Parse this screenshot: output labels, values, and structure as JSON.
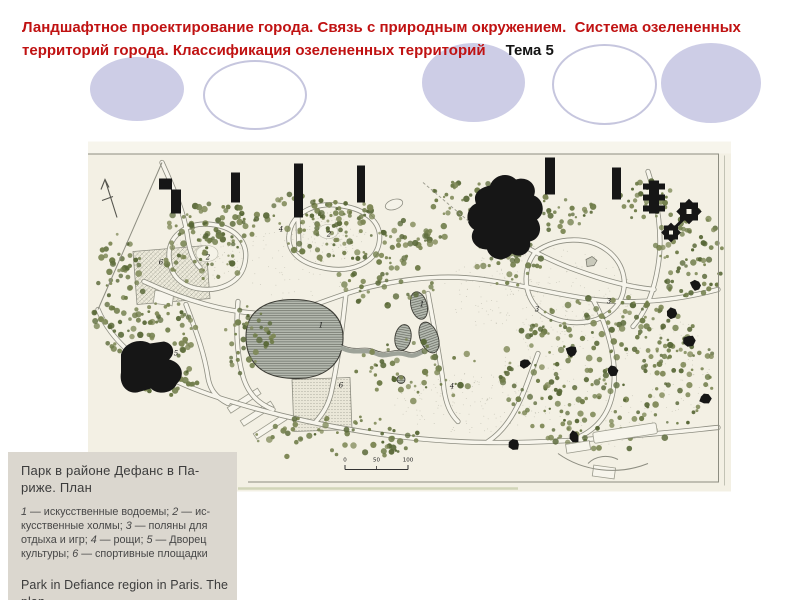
{
  "header": {
    "title": "Ландшафтное проектирование города. Связь с природным окружением.  Система озелененных территорий города. Классификация озелененных территорий",
    "topic": "Тема 5"
  },
  "colors": {
    "title_red": "#c01212",
    "topic_black": "#141414",
    "ellipse_fill": "#cdcde6",
    "ellipse_stroke": "#c6c6de",
    "plan_paper": "#f3f0e4",
    "plan_line": "#8d8d81",
    "tree_green": "#6f7c49",
    "building_black": "#161616",
    "pond_fill": "#b7bcb2",
    "caption_bg": "#dbd7cf",
    "caption_text": "#3c3c3c"
  },
  "plan": {
    "labels": [
      {
        "n": "6",
        "x": 73,
        "y": 123
      },
      {
        "n": "2",
        "x": 120,
        "y": 118
      },
      {
        "n": "4",
        "x": 193,
        "y": 90
      },
      {
        "n": "2",
        "x": 241,
        "y": 95
      },
      {
        "n": "1",
        "x": 233,
        "y": 186
      },
      {
        "n": "1",
        "x": 334,
        "y": 165
      },
      {
        "n": "3",
        "x": 449,
        "y": 170
      },
      {
        "n": "3",
        "x": 521,
        "y": 162
      },
      {
        "n": "5",
        "x": 88,
        "y": 214
      },
      {
        "n": "6",
        "x": 253,
        "y": 246
      },
      {
        "n": "4",
        "x": 364,
        "y": 247
      }
    ],
    "scale_ticks": [
      "0",
      "50",
      "100"
    ]
  },
  "caption": {
    "title_ru": "Парк в районе Дефанс в Па-риже. План",
    "legend": [
      {
        "num": "1",
        "text": " — искусственные водоемы; "
      },
      {
        "num": "2",
        "text": " — ис-кусственные холмы; "
      },
      {
        "num": "3",
        "text": " — поляны для отдыха и игр; "
      },
      {
        "num": "4",
        "text": " — рощи; "
      },
      {
        "num": "5",
        "text": " — Дворец культуры; "
      },
      {
        "num": "6",
        "text": " — спортивные площадки"
      }
    ],
    "title_en": "Park in Defiance region in Paris. The plan"
  }
}
